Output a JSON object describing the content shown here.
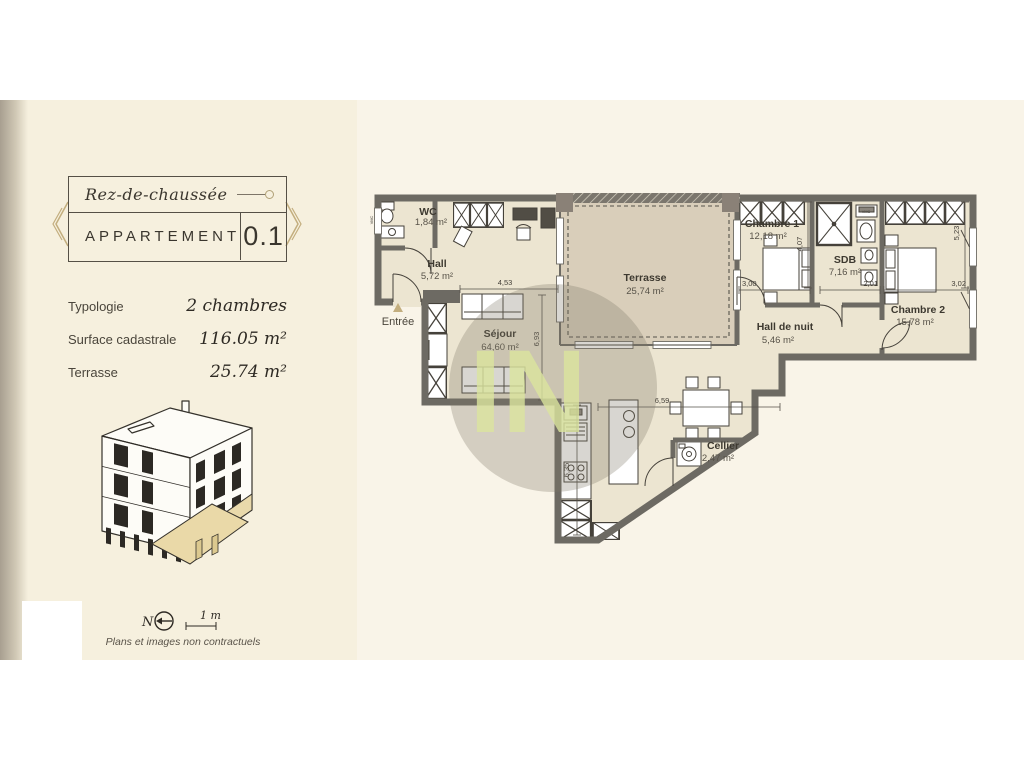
{
  "sidebar": {
    "floor": "Rez-de-chaussée",
    "unit_label": "APPARTEMENT",
    "unit_number": "0.1",
    "details": {
      "typologie": {
        "label": "Typologie",
        "value": "2 chambres"
      },
      "surface": {
        "label": "Surface cadastrale",
        "value": "116.05 m²"
      },
      "terrasse": {
        "label": "Terrasse",
        "value": "25.74 m²"
      }
    },
    "footer": {
      "north": "N",
      "scale": "1 m",
      "disclaimer": "Plans et images non contractuels"
    }
  },
  "plan": {
    "watermark": "IN",
    "entrance": "Entrée",
    "rooms": {
      "wc": {
        "name": "WC",
        "area": "1,84 m²"
      },
      "hall": {
        "name": "Hall",
        "area": "5,72 m²"
      },
      "sejour": {
        "name": "Séjour",
        "area": "64,60 m²"
      },
      "terrasse": {
        "name": "Terrasse",
        "area": "25,74 m²"
      },
      "chambre1": {
        "name": "Chambre 1",
        "area": "12,18 m²"
      },
      "sdb": {
        "name": "SDB",
        "area": "7,16 m²"
      },
      "hall_nuit": {
        "name": "Hall de nuit",
        "area": "5,46 m²"
      },
      "chambre2": {
        "name": "Chambre 2",
        "area": "15,78 m²"
      },
      "cellier": {
        "name": "Cellier",
        "area": "2,47 m²"
      }
    },
    "dims": {
      "hall_w": "4,53",
      "sejour_h": "6,93",
      "ch1_w": "3,00",
      "ch1_h": "4,07",
      "sdb_w": "2,01",
      "ch2_w": "3,02",
      "ch2_h": "5,23",
      "living_w": "6,59",
      "living_h": "6,35"
    },
    "labels": {
      "vmc": "VMC"
    }
  },
  "colors": {
    "accent_tan": "#c3ae7e",
    "wall_gray": "#6d6a63",
    "floor_cream": "#ece5d1",
    "terrace_beige": "#d9ceba",
    "watermark_green": "#dbe59d",
    "ink": "#3d3930"
  }
}
